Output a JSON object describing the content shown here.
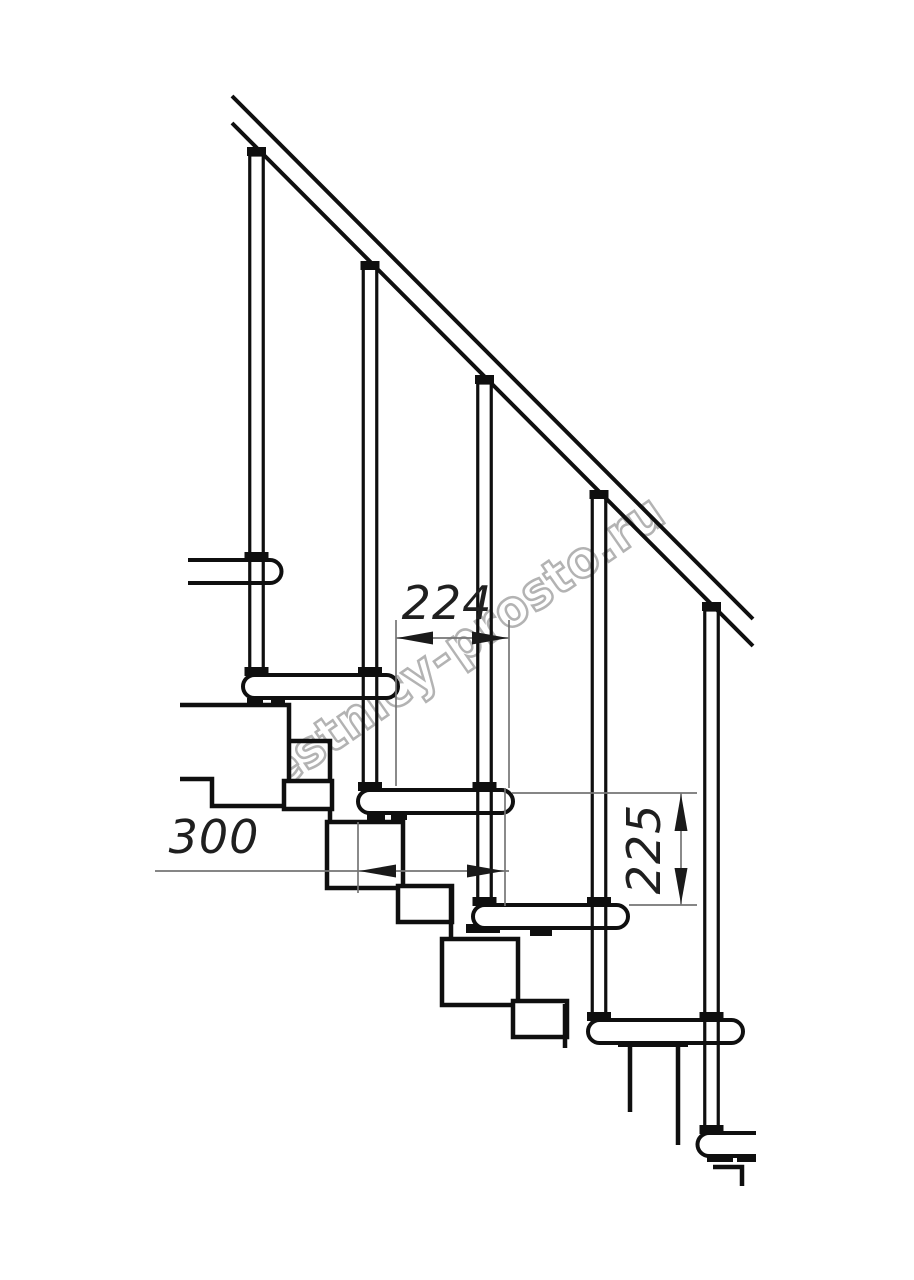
{
  "drawing": {
    "watermark_text": "lestnicy-prosto.ru",
    "dimensions": {
      "step_run": "224",
      "tread_depth": "300",
      "step_rise": "225"
    }
  }
}
